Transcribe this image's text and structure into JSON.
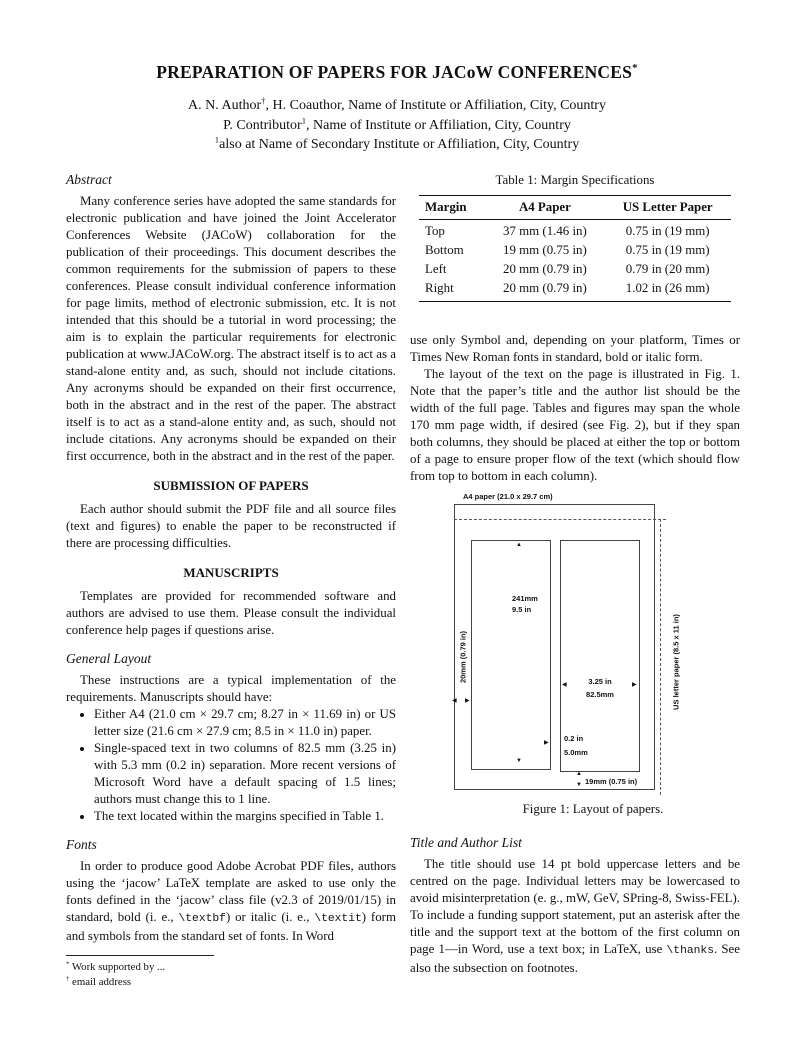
{
  "header": {
    "title": [
      {
        "t": "PREPARATION OF PAPERS FOR JACoW CONFERENCES"
      },
      {
        "t": "*",
        "s": "sup"
      }
    ],
    "author_lines": [
      [
        {
          "t": "A. N. Author"
        },
        {
          "t": "†",
          "s": "sup"
        },
        {
          "t": ", H. Coauthor, Name of Institute or Affiliation, City, Country"
        }
      ],
      [
        {
          "t": "P. Contributor"
        },
        {
          "t": "1",
          "s": "sup"
        },
        {
          "t": ", Name of Institute or Affiliation, City, Country"
        }
      ],
      [
        {
          "t": "1",
          "s": "sup"
        },
        {
          "t": "also at Name of Secondary Institute or Affiliation, City, Country"
        }
      ]
    ]
  },
  "left_column": {
    "abstract_heading": "Abstract",
    "abstract_text": "Many conference series have adopted the same standards for electronic publication and have joined the Joint Accelerator Conferences Website (JACoW) collaboration for the publication of their proceedings. This document describes the common requirements for the submission of papers to these conferences. Please consult individual conference information for page limits, method of electronic submission, etc. It is not intended that this should be a tutorial in word processing; the aim is to explain the particular requirements for electronic publication at www.JACoW.org. The abstract itself is to act as a stand-alone entity and, as such, should not include citations. Any acronyms should be expanded on their first occurrence, both in the abstract and in the rest of the paper. The abstract itself is to act as a stand-alone entity and, as such, should not include citations. Any acronyms should be expanded on their first occurrence, both in the abstract and in the rest of the paper.",
    "submission_heading": "SUBMISSION OF PAPERS",
    "submission_text": "Each author should submit the PDF file and all source files (text and figures) to enable the paper to be reconstructed if there are processing difficulties.",
    "manuscripts_heading": "MANUSCRIPTS",
    "manuscripts_text": "Templates are provided for recommended software and authors are advised to use them. Please consult the individual conference help pages if questions arise.",
    "general_layout_heading": "General Layout",
    "general_layout_intro": "These instructions are a typical implementation of the requirements. Manuscripts should have:",
    "bullets": [
      "Either A4 (21.0 cm × 29.7 cm; 8.27 in × 11.69 in) or US letter size (21.6 cm × 27.9 cm; 8.5 in × 11.0 in) paper.",
      "Single-spaced text in two columns of 82.5 mm (3.25 in) with 5.3 mm (0.2 in) separation. More recent versions of Microsoft Word have a default spacing of 1.5 lines; authors must change this to 1 line.",
      "The text located within the margins specified in Table 1."
    ],
    "fonts_heading": "Fonts",
    "fonts_text": [
      {
        "t": "In order to produce good Adobe Acrobat PDF files, authors using the ‘jacow’ "
      },
      {
        "t": "LaTeX",
        "s": "latex"
      },
      {
        "t": " template are asked to use only the fonts defined in the ‘jacow’ class file (v2.3 of 2019/01/15) in standard, bold (i. e., "
      },
      {
        "t": "\\textbf",
        "s": "tt"
      },
      {
        "t": ") or italic (i. e., "
      },
      {
        "t": "\\textit",
        "s": "tt"
      },
      {
        "t": ") form and symbols from the standard set of fonts. In Word"
      }
    ],
    "footnotes": [
      [
        {
          "t": "*",
          "s": "sup"
        },
        {
          "t": " Work supported by ..."
        }
      ],
      [
        {
          "t": "†",
          "s": "sup"
        },
        {
          "t": " email address"
        }
      ]
    ]
  },
  "right_column": {
    "table": {
      "caption": "Table 1: Margin Specifications",
      "headers": [
        "Margin",
        "A4 Paper",
        "US Letter Paper"
      ],
      "rows": [
        [
          "Top",
          "37 mm (1.46 in)",
          "0.75 in (19 mm)"
        ],
        [
          "Bottom",
          "19 mm (0.75 in)",
          "0.75 in (19 mm)"
        ],
        [
          "Left",
          "20 mm (0.79 in)",
          "0.79 in (20 mm)"
        ],
        [
          "Right",
          "20 mm (0.79 in)",
          "1.02 in (26 mm)"
        ]
      ]
    },
    "para1": "use only Symbol and, depending on your platform, Times or Times New Roman fonts in standard, bold or italic form.",
    "para2": "The layout of the text on the page is illustrated in Fig. 1. Note that the paper’s title and the author list should be the width of the full page. Tables and figures may span the whole 170 mm page width, if desired (see Fig. 2), but if they span both columns, they should be placed at either the top or bottom of a page to ensure proper flow of the text (which should flow from top to bottom in each column).",
    "figure": {
      "a4_label": "A4 paper (21.0 x 29.7 cm)",
      "us_letter_label": "US letter paper (8.5 x 11 in)",
      "col_height_mm": "241mm",
      "col_height_in": "9.5 in",
      "left_margin_label": "20mm (0.79 in)",
      "col_width_in": "3.25 in",
      "col_width_mm": "82.5mm",
      "gap_in": "0.2 in",
      "gap_mm": "5.0mm",
      "bottom_margin_label": "19mm (0.75 in)",
      "caption": "Figure 1: Layout of papers."
    },
    "title_author_heading": "Title and Author List",
    "title_author_text": [
      {
        "t": "The title should use 14 pt bold uppercase letters and be centred on the page. Individual letters may be lowercased to avoid misinterpretation (e. g., mW, GeV, SPring-8, Swiss-FEL). To include a funding support statement, put an asterisk after the title and the support text at the bottom of the first column on page 1—in Word, use a text box; in "
      },
      {
        "t": "LaTeX",
        "s": "latex"
      },
      {
        "t": ", use "
      },
      {
        "t": "\\thanks",
        "s": "tt"
      },
      {
        "t": ". See also the subsection on footnotes."
      }
    ]
  }
}
